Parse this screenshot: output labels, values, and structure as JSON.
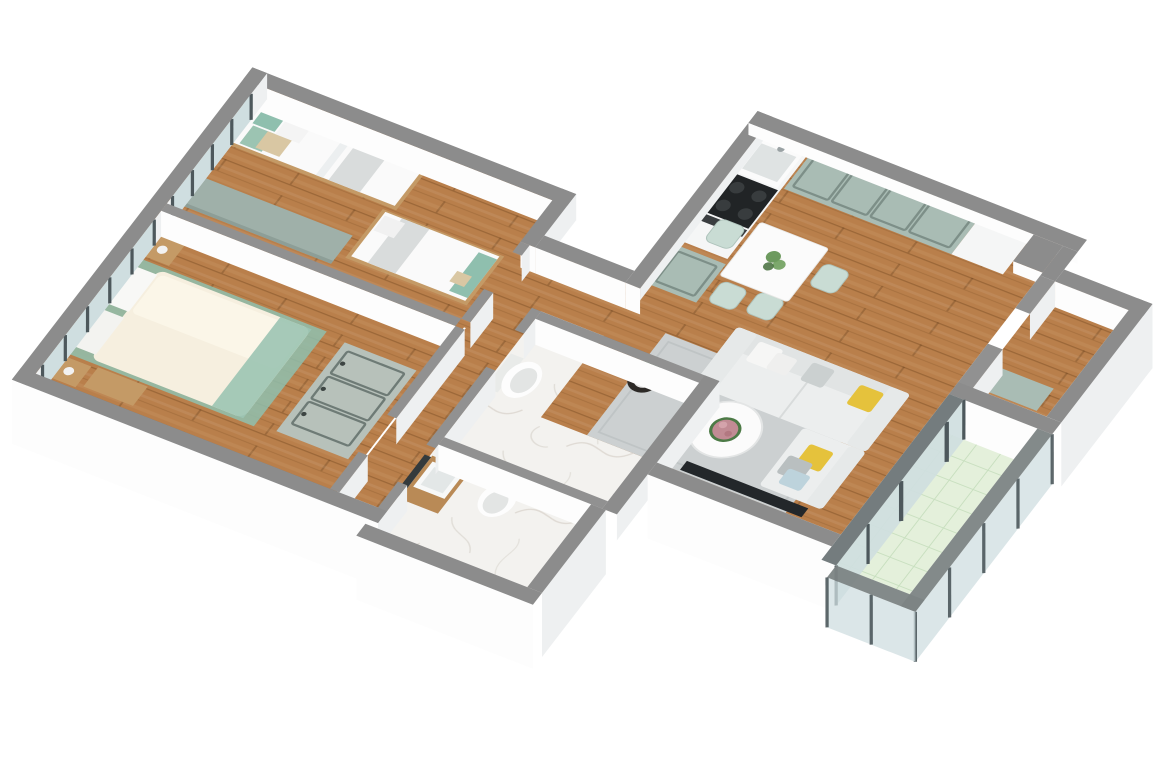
{
  "scene": {
    "type": "3d-floor-plan",
    "style": "isometric dollhouse cutaway render of an apartment, viewed from above at an angle",
    "background": "#ffffff"
  },
  "palette": {
    "background": "#ffffff",
    "wall-top": "#8c8c8c",
    "wall-top-int": "#919191",
    "wall-face": "#fdfdfd",
    "wall-face-side": "#eef0f1",
    "floor-wood": "#b97f4b",
    "wood-seam": "rgba(80,40,8,0.28)",
    "floor-marble": "#f3f2ef",
    "marble-vein": "#d9d5cd",
    "floor-tile": "#e4f0db",
    "tile-line": "#c8dfbf",
    "cabinet-sage": "#a9bcb4",
    "wardrobe-sage": "#b7c1ba",
    "desk-sage": "#9fb0a9",
    "counter-white": "#f5f6f6",
    "stove-black": "#212426",
    "sofa": "#eceeee",
    "sofa-shade": "#e1e4e4",
    "rug": "#ccd0d1",
    "rug-border": "#bfc4c5",
    "accent-yellow": "#e5c23c",
    "accent-blue": "#bdd3dc",
    "accent-teal": "#8fbfae",
    "bed-cream": "#f6efdf",
    "wood-furniture": "#c49a66",
    "vanity-wood": "#b98a56",
    "plant-green": "#5d8f4e",
    "plant-dark": "#39652f",
    "flower-pink": "#c18b94",
    "pot-black": "#2d2a27",
    "glass": "#cfdee0",
    "frame-dark": "#4d585c",
    "mirror-dark": "#343a3c",
    "table-white": "#fbfbfb",
    "chair-mint": "#c9dcd4",
    "fixture-white": "#fdfdfd",
    "basin-gray": "#e3e7e7"
  },
  "rooms": [
    {
      "id": "kids-bedroom",
      "floor": "wood",
      "furniture": [
        "single-bed",
        "single-bed",
        "desk-dresser"
      ]
    },
    {
      "id": "master-bedroom",
      "floor": "wood",
      "furniture": [
        "double-bed",
        "nightstands",
        "wardrobe"
      ]
    },
    {
      "id": "hallway",
      "floor": "wood",
      "furniture": []
    },
    {
      "id": "bathroom-1",
      "floor": "marble",
      "furniture": [
        "toilet",
        "vanity",
        "mirror"
      ]
    },
    {
      "id": "bathroom-2",
      "floor": "marble",
      "furniture": [
        "toilet",
        "wood-vanity",
        "mirror"
      ]
    },
    {
      "id": "kitchen",
      "floor": "wood",
      "furniture": [
        "sink",
        "stove",
        "cabinets",
        "counter",
        "tall-cabinet"
      ]
    },
    {
      "id": "dining-area",
      "floor": "wood",
      "furniture": [
        "square-table",
        "chairs",
        "plant"
      ]
    },
    {
      "id": "living-room",
      "floor": "wood",
      "furniture": [
        "sofa",
        "chaise",
        "coffee-table",
        "rug",
        "floor-plant",
        "tv"
      ]
    },
    {
      "id": "east-room",
      "floor": "wood",
      "furniture": [
        "cabinet"
      ]
    },
    {
      "id": "balcony",
      "floor": "tile",
      "furniture": []
    }
  ]
}
